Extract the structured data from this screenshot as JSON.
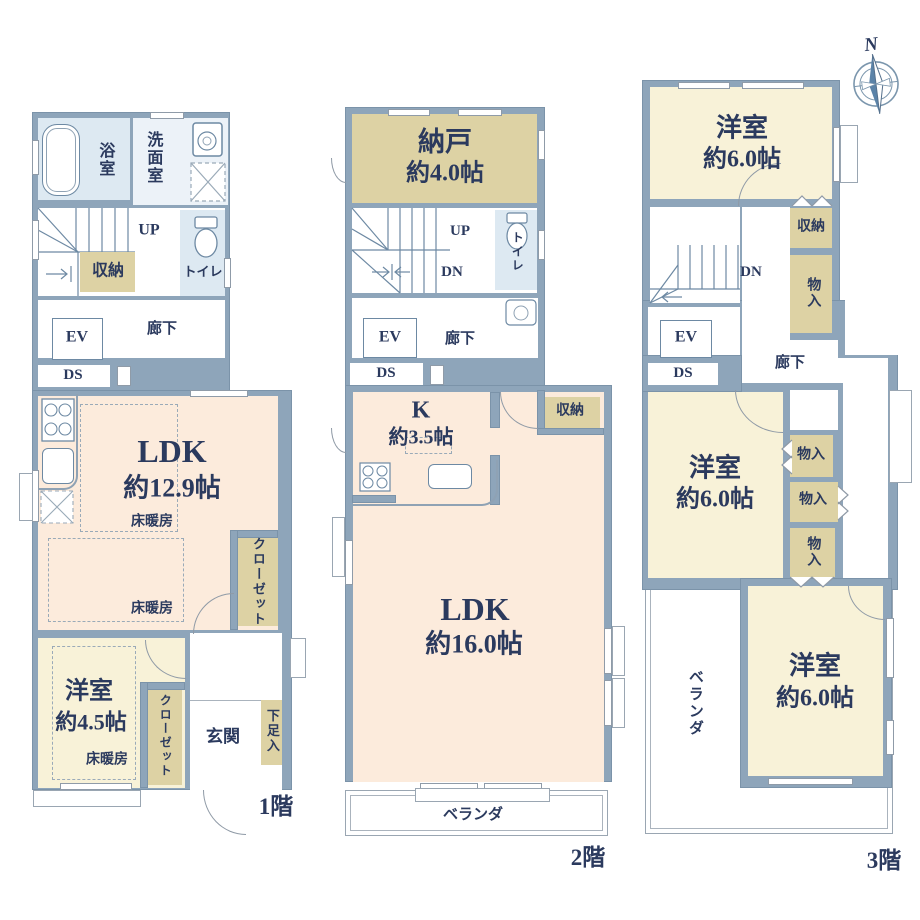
{
  "colors": {
    "wall": "#8ea5ba",
    "room_peach": "#fcebdc",
    "room_cream": "#f8f2d8",
    "room_tan": "#ddd2a4",
    "room_blue": "#dde9f2",
    "text": "#2b3a5e"
  },
  "compass": {
    "north": "N"
  },
  "f1": {
    "floor": "1階",
    "bath": "浴室",
    "wash": "洗面室",
    "up": "UP",
    "storage": "収納",
    "toilet": "トイレ",
    "ev": "EV",
    "hall": "廊下",
    "ds": "DS",
    "ldk": "LDK",
    "ldk_size": "約12.9帖",
    "heat1": "床暖房",
    "heat2": "床暖房",
    "closet1": "クローゼット",
    "bed": "洋室",
    "bed_size": "約4.5帖",
    "heat3": "床暖房",
    "closet2": "クローゼット",
    "entrance": "玄関",
    "shoe": "下足入"
  },
  "f2": {
    "floor": "2階",
    "nando": "納戸",
    "nando_size": "約4.0帖",
    "up": "UP",
    "dn": "DN",
    "toilet": "トイレ",
    "ev": "EV",
    "hall": "廊下",
    "ds": "DS",
    "k": "K",
    "k_size": "約3.5帖",
    "storage": "収納",
    "ldk": "LDK",
    "ldk_size": "約16.0帖",
    "veranda": "ベランダ"
  },
  "f3": {
    "floor": "3階",
    "bed1": "洋室",
    "bed1_size": "約6.0帖",
    "storage": "収納",
    "mono1": "物入",
    "dn": "DN",
    "ev": "EV",
    "ds": "DS",
    "hall": "廊下",
    "bed2": "洋室",
    "bed2_size": "約6.0帖",
    "mono2": "物入",
    "mono3": "物入",
    "mono4": "物入",
    "veranda": "ベランダ",
    "bed3": "洋室",
    "bed3_size": "約6.0帖"
  }
}
